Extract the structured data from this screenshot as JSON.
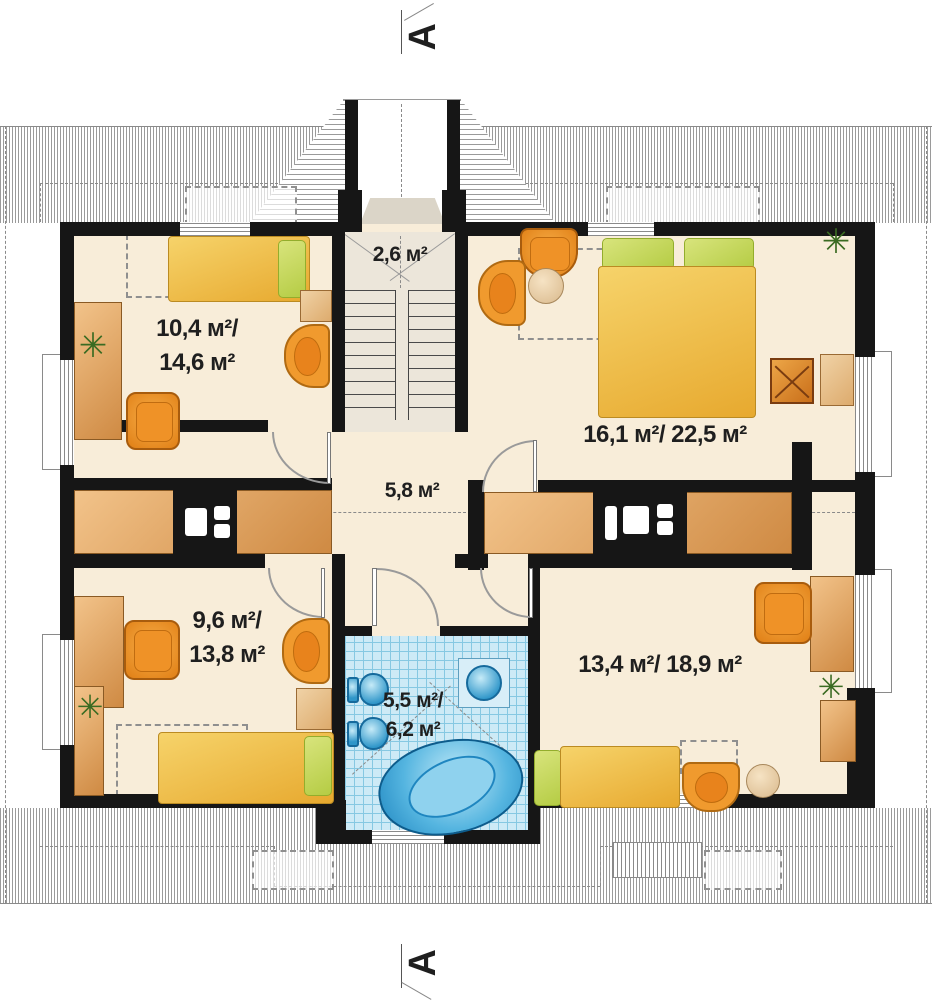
{
  "plan": {
    "title": "attic floor plan",
    "section_marker_top": "A",
    "section_marker_bottom": "A",
    "rooms": {
      "staircase": {
        "area": "2,6 м²"
      },
      "bedroom_top_left": {
        "area_line1": "10,4 м²/",
        "area_line2": "14,6 м²"
      },
      "bedroom_top_right": {
        "area": "16,1 м²/ 22,5 м²"
      },
      "hall": {
        "area": "5,8 м²"
      },
      "bedroom_bottom_left": {
        "area_line1": "9,6 м²/",
        "area_line2": "13,8 м²"
      },
      "bathroom": {
        "area_line1": "5,5 м²/",
        "area_line2": "6,2 м²"
      },
      "bedroom_bottom_right": {
        "area": "13,4 м²/ 18,9 м²"
      }
    },
    "colors": {
      "floor": "#f8edd9",
      "wall": "#161616",
      "wood": "#cf8a43",
      "bed_yellow": "#e7a92f",
      "pillow_green": "#b5cc44",
      "chair_orange": "#ef9227",
      "bath_tile": "#cdeaf6",
      "fixture_blue": "#2f96c9",
      "roof_hatch": "#9a9a9a"
    },
    "plant_glyph": "✳"
  }
}
